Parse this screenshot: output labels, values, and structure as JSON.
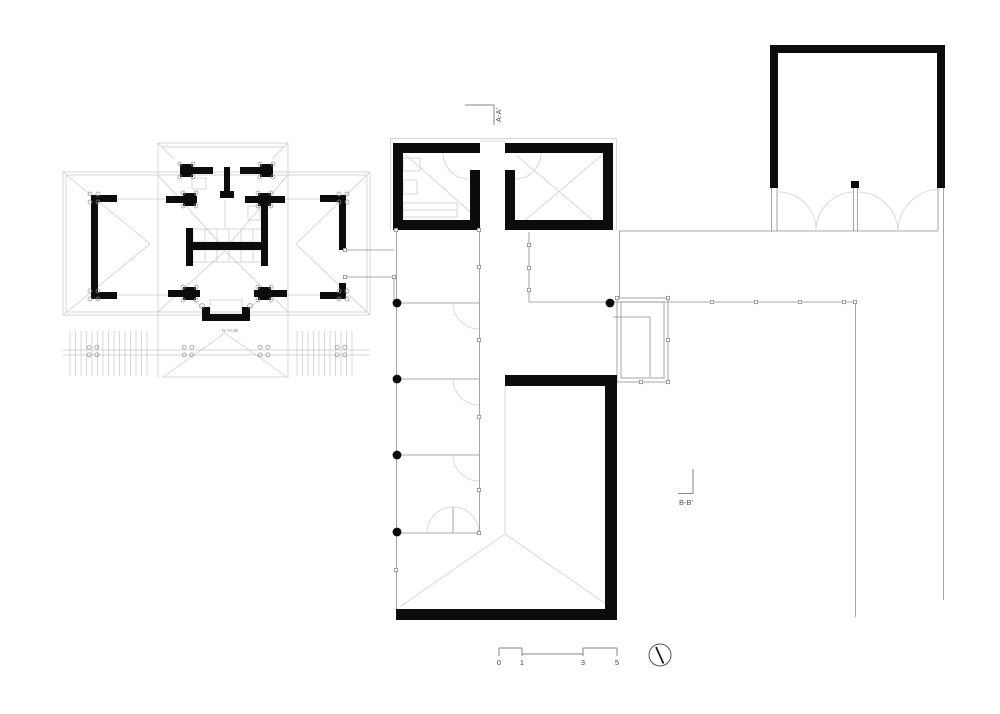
{
  "meta": {
    "title": "Architectural ground floor plan drawing",
    "background": "#ffffff"
  },
  "labels": {
    "section_a": "A-A'",
    "section_b": "B-B'",
    "level_marker": "N +0.38",
    "scale": {
      "t0": "0",
      "t1": "1",
      "t3": "3",
      "t5": "5"
    }
  },
  "colors": {
    "wall": "#0c0c0c",
    "thin_line": "#c7c7c7",
    "medium_line": "#8f8f8f",
    "marker_line": "#868686",
    "text": "#444444"
  },
  "geometry": {
    "walls": [
      [
        91,
        195,
        7,
        104
      ],
      [
        91,
        195,
        26,
        7
      ],
      [
        91,
        292,
        26,
        7
      ],
      [
        339,
        195,
        7,
        55
      ],
      [
        339,
        283,
        7,
        16
      ],
      [
        320,
        195,
        26,
        7
      ],
      [
        320,
        292,
        26,
        7
      ],
      [
        183,
        167,
        30,
        7
      ],
      [
        240,
        167,
        30,
        7
      ],
      [
        180,
        164,
        13,
        13
      ],
      [
        260,
        164,
        13,
        13
      ],
      [
        224,
        167,
        6,
        26
      ],
      [
        220,
        191,
        14,
        7
      ],
      [
        166,
        196,
        31,
        7
      ],
      [
        183,
        193,
        13,
        13
      ],
      [
        245,
        196,
        40,
        7
      ],
      [
        258,
        193,
        13,
        13
      ],
      [
        261,
        203,
        7,
        63
      ],
      [
        186,
        228,
        7,
        38
      ],
      [
        186,
        242,
        80,
        8
      ],
      [
        168,
        290,
        32,
        7
      ],
      [
        183,
        287,
        13,
        13
      ],
      [
        254,
        290,
        33,
        7
      ],
      [
        258,
        287,
        13,
        13
      ],
      [
        202,
        307,
        8,
        14
      ],
      [
        202,
        314,
        48,
        7
      ],
      [
        242,
        307,
        8,
        14
      ],
      [
        393,
        143,
        87,
        10
      ],
      [
        393,
        143,
        10,
        87
      ],
      [
        393,
        220,
        87,
        10
      ],
      [
        470,
        170,
        10,
        60
      ],
      [
        505,
        143,
        108,
        10
      ],
      [
        603,
        143,
        10,
        87
      ],
      [
        505,
        220,
        108,
        10
      ],
      [
        505,
        170,
        10,
        60
      ],
      [
        505,
        375,
        112,
        11
      ],
      [
        605,
        375,
        12,
        245
      ],
      [
        396,
        609,
        221,
        11
      ],
      [
        770,
        45,
        175,
        8
      ],
      [
        770,
        45,
        8,
        143
      ],
      [
        937,
        45,
        8,
        143
      ],
      [
        851,
        181,
        8,
        7
      ]
    ],
    "dots": [
      [
        397,
        303,
        4.4
      ],
      [
        397,
        379,
        4.4
      ],
      [
        397,
        455,
        4.4
      ],
      [
        397,
        532,
        4.4
      ],
      [
        610,
        303,
        4.4
      ]
    ],
    "med": [
      [
        396.5,
        230,
        396.5,
        609
      ],
      [
        479.5,
        230,
        479.5,
        533
      ],
      [
        397,
        303,
        479,
        303
      ],
      [
        397,
        379,
        479,
        379
      ],
      [
        397,
        455,
        479,
        455
      ],
      [
        397,
        533,
        479,
        533
      ],
      [
        453,
        507,
        453,
        533
      ],
      [
        529,
        232,
        529,
        302
      ],
      [
        529,
        302,
        668,
        302
      ],
      [
        345,
        250,
        394,
        250
      ],
      [
        345,
        277,
        394,
        277
      ],
      [
        394,
        277,
        394,
        300
      ],
      [
        619,
        231,
        938,
        231
      ],
      [
        619.5,
        231,
        619.5,
        298
      ],
      [
        613,
        317,
        650,
        317
      ],
      [
        650,
        317,
        650,
        377
      ],
      [
        668,
        302,
        855,
        302
      ],
      [
        855.5,
        302,
        855.5,
        617
      ],
      [
        943.5,
        188,
        943.5,
        600
      ],
      [
        853.5,
        188,
        853.5,
        231
      ],
      [
        857.5,
        188,
        857.5,
        231
      ],
      [
        771.5,
        188,
        771.5,
        231
      ],
      [
        777,
        188,
        777,
        231
      ],
      [
        938,
        188,
        938,
        231
      ]
    ],
    "thin": [
      [
        63,
        172,
        370,
        172
      ],
      [
        63,
        315,
        370,
        315
      ],
      [
        63,
        172,
        63,
        315
      ],
      [
        370,
        172,
        370,
        315
      ],
      [
        66,
        175,
        367,
        175
      ],
      [
        66,
        175,
        66,
        312
      ],
      [
        367,
        175,
        367,
        312
      ],
      [
        66,
        312,
        367,
        312
      ],
      [
        158,
        143,
        288,
        143
      ],
      [
        158,
        143,
        158,
        378
      ],
      [
        288,
        143,
        288,
        378
      ],
      [
        162,
        147,
        284,
        147
      ],
      [
        63,
        172,
        150,
        244
      ],
      [
        63,
        315,
        150,
        244
      ],
      [
        370,
        172,
        296,
        244
      ],
      [
        370,
        315,
        296,
        244
      ],
      [
        158,
        175,
        225,
        249
      ],
      [
        288,
        175,
        225,
        249
      ],
      [
        158,
        312,
        225,
        251
      ],
      [
        288,
        312,
        225,
        251
      ],
      [
        158,
        143,
        174,
        159
      ],
      [
        288,
        143,
        272,
        159
      ],
      [
        225,
        199,
        225,
        228
      ],
      [
        117,
        199,
        183,
        199
      ],
      [
        271,
        199,
        320,
        199
      ],
      [
        117,
        295,
        183,
        295
      ],
      [
        271,
        295,
        320,
        295
      ],
      [
        63,
        350,
        370,
        350
      ],
      [
        63,
        355,
        370,
        355
      ],
      [
        225,
        333,
        163,
        377
      ],
      [
        225,
        333,
        287,
        377
      ],
      [
        163,
        377,
        287,
        377
      ],
      [
        202,
        307,
        189,
        297
      ],
      [
        250,
        307,
        263,
        297
      ],
      [
        205,
        229,
        205,
        242
      ],
      [
        217,
        229,
        217,
        242
      ],
      [
        229,
        229,
        229,
        242
      ],
      [
        241,
        229,
        241,
        242
      ],
      [
        253,
        229,
        253,
        242
      ],
      [
        205,
        250,
        205,
        262
      ],
      [
        217,
        250,
        217,
        262
      ],
      [
        229,
        250,
        229,
        262
      ],
      [
        241,
        250,
        241,
        262
      ],
      [
        253,
        250,
        253,
        262
      ],
      [
        406,
        155,
        477,
        218
      ],
      [
        516,
        155,
        602,
        228
      ],
      [
        602,
        155,
        516,
        228
      ],
      [
        403,
        210,
        457,
        210
      ],
      [
        505,
        386,
        505,
        533
      ],
      [
        401,
        606,
        505,
        534
      ],
      [
        609,
        606,
        505,
        534
      ],
      [
        390,
        138.5,
        617,
        138.5
      ],
      [
        390.5,
        138.5,
        390.5,
        230
      ],
      [
        616.5,
        138.5,
        616.5,
        230
      ],
      [
        480,
        141,
        505,
        141
      ]
    ],
    "rects": [
      [
        192,
        178,
        14,
        11
      ],
      [
        248,
        206,
        12,
        14
      ],
      [
        193,
        229,
        73,
        13
      ],
      [
        193,
        250,
        73,
        12
      ],
      [
        210,
        300,
        32,
        14
      ],
      [
        403,
        158,
        17,
        13
      ],
      [
        403,
        180,
        14,
        14
      ],
      [
        403,
        203,
        54,
        14
      ]
    ],
    "mrects": [
      [
        617,
        298,
        51,
        84
      ],
      [
        621,
        302,
        43,
        76
      ]
    ],
    "arcs": [
      "M443,153 A26,26 0 0 0 469,179",
      "M541,153 A26,26 0 0 1 515,179",
      "M453,303 A26,26 0 0 0 479,329",
      "M453,379 A26,26 0 0 0 479,405",
      "M453,455 A26,26 0 0 0 479,481",
      "M427,533 A26,26 0 0 1 479,533",
      "M778,192 A38,38 0 0 1 816,230",
      "M855,192 A39,39 0 0 0 816,230",
      "M857,192 A41,41 0 0 1 898,230",
      "M941,189 A43,43 0 0 0 898,230"
    ],
    "squares": [
      [
        396,
        230
      ],
      [
        479,
        230
      ],
      [
        529,
        245
      ],
      [
        529,
        268
      ],
      [
        529,
        290
      ],
      [
        479,
        267
      ],
      [
        479,
        340
      ],
      [
        479,
        417
      ],
      [
        479,
        490
      ],
      [
        479,
        533
      ],
      [
        396,
        570
      ],
      [
        617,
        298
      ],
      [
        668,
        298
      ],
      [
        668,
        340
      ],
      [
        668,
        382
      ],
      [
        641,
        382
      ],
      [
        712,
        302
      ],
      [
        756,
        302
      ],
      [
        800,
        302
      ],
      [
        844,
        302
      ],
      [
        855,
        302
      ],
      [
        345,
        250
      ],
      [
        345,
        277
      ],
      [
        394,
        277
      ]
    ],
    "clusters": [
      [
        94,
        198,
        4,
        2
      ],
      [
        94,
        295,
        4,
        2
      ],
      [
        343,
        198,
        4,
        2
      ],
      [
        343,
        295,
        4,
        2
      ],
      [
        186.5,
        170.5,
        6.5,
        2
      ],
      [
        266.5,
        170.5,
        6.5,
        2
      ],
      [
        189.5,
        199.5,
        6.5,
        2
      ],
      [
        264.5,
        199.5,
        6.5,
        2
      ],
      [
        189.5,
        293.5,
        6.5,
        2
      ],
      [
        264.5,
        293.5,
        6.5,
        2
      ],
      [
        93,
        351,
        3.8,
        2
      ],
      [
        188,
        351,
        3.8,
        2
      ],
      [
        264,
        351,
        3.8,
        2
      ],
      [
        341,
        351,
        3.8,
        2
      ]
    ],
    "circles": [
      [
        202,
        306,
        2.4
      ],
      [
        250,
        306,
        2.4
      ]
    ],
    "hatches": [
      [
        70,
        147,
        5.5,
        331,
        376
      ],
      [
        297,
        357,
        5.5,
        331,
        376
      ]
    ],
    "marks": [
      [
        465,
        105,
        494,
        105
      ],
      [
        494,
        105,
        494,
        125
      ],
      [
        678,
        493.5,
        693,
        493.5
      ],
      [
        693,
        469,
        693,
        493.5
      ],
      [
        499,
        648,
        522,
        648
      ],
      [
        583,
        648,
        617,
        648
      ],
      [
        522,
        654,
        583,
        654
      ],
      [
        499,
        648,
        499,
        656
      ],
      [
        522,
        648,
        522,
        656
      ],
      [
        583,
        648,
        583,
        656
      ],
      [
        617,
        648,
        617,
        656
      ]
    ],
    "compass": {
      "cx": 660,
      "cy": 655,
      "r": 11,
      "needle": [
        656,
        647,
        663.5,
        663.5
      ]
    }
  }
}
